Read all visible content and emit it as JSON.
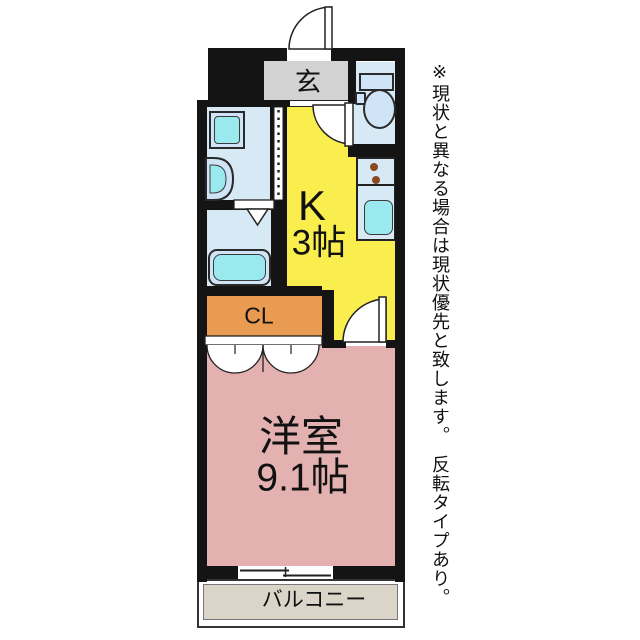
{
  "plan": {
    "genkan": {
      "label": "玄",
      "color": "#d2d2d2"
    },
    "kitchen": {
      "name": "K",
      "size": "3帖",
      "color": "#f9ee4e"
    },
    "closet": {
      "label": "CL",
      "color": "#ea9b52"
    },
    "western_room": {
      "name": "洋室",
      "size": "9.1帖",
      "color": "#e3b2b0"
    },
    "balcony": {
      "label": "バルコニー",
      "color": "#dbd4c9"
    },
    "wet_area_color": "#d8e9f6",
    "fixture_color": "#9ae9ef",
    "wall_color": "#141414",
    "burner_color": "#8a4a1e",
    "note": "※現状と異なる場合は現状優先と致します。　反転タイプあり。",
    "fixtures": [
      "entrance-door",
      "toilet",
      "washing-machine",
      "wash-basin",
      "bathtub",
      "kitchen-sink",
      "stove-burners",
      "folding-door",
      "closet-doors",
      "sliding-window"
    ]
  }
}
